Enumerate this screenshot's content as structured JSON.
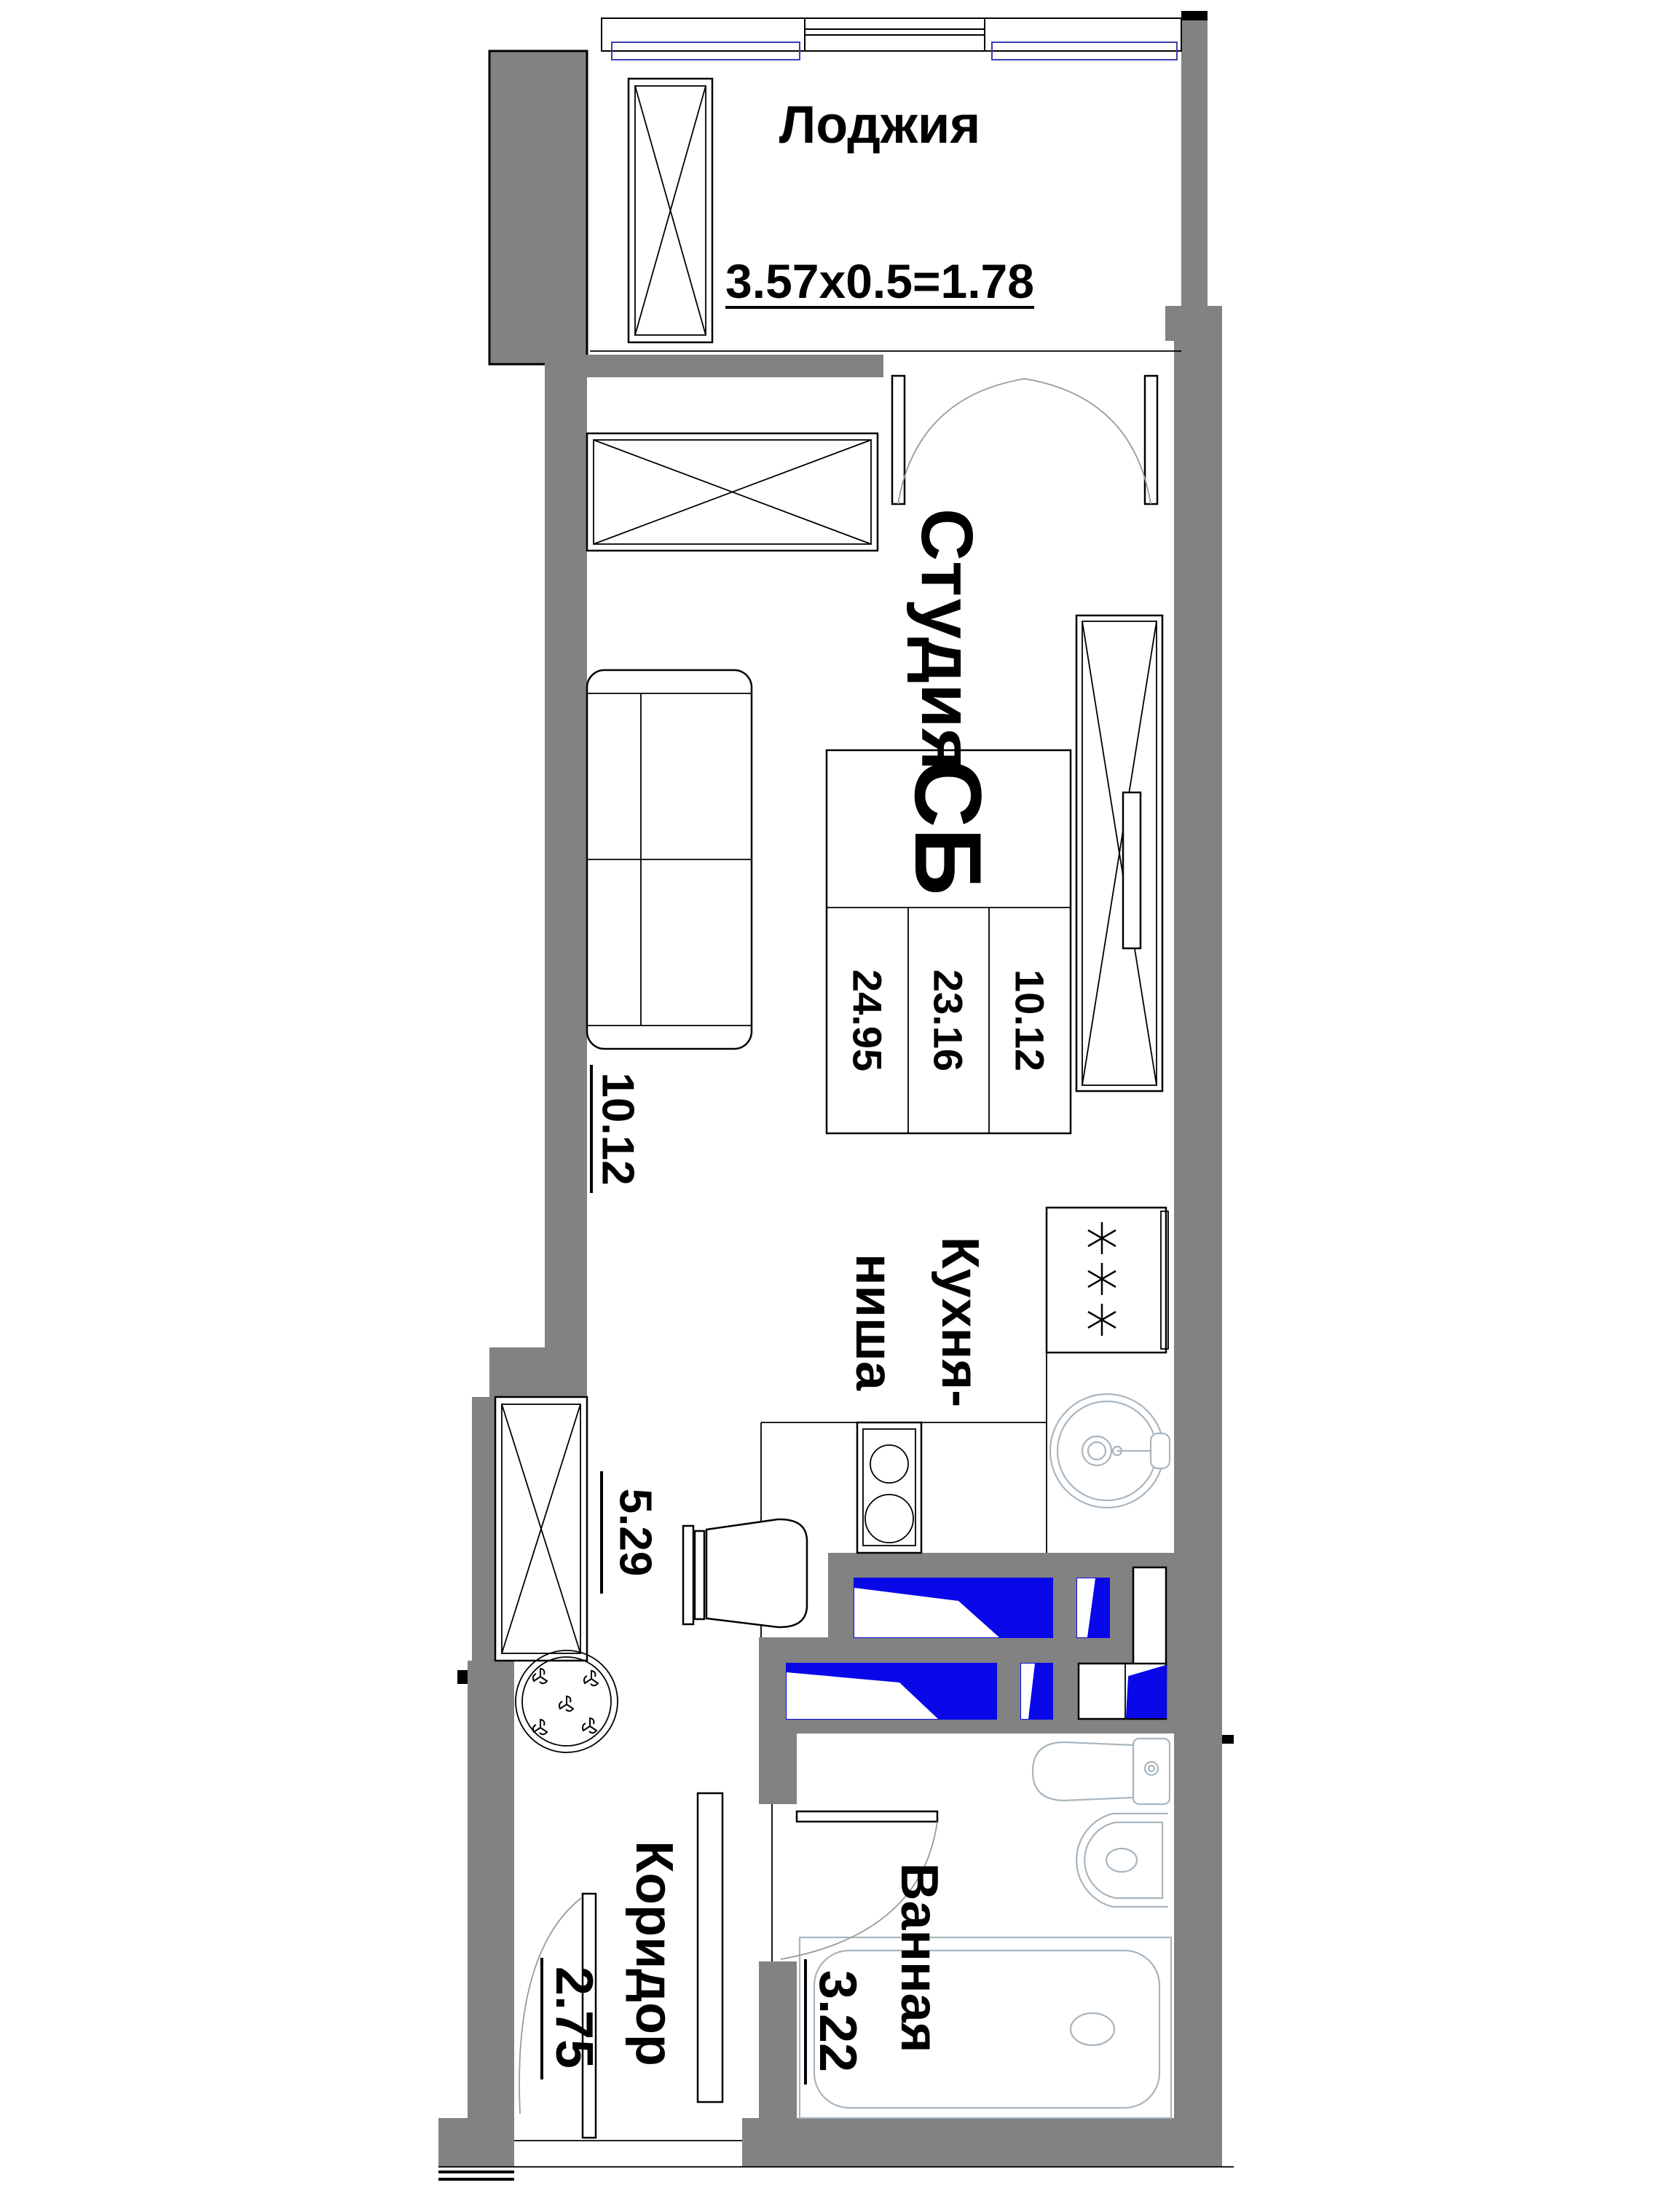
{
  "plan": {
    "title": "Studio apartment floor plan",
    "rooms": {
      "loggia": {
        "name": "Лоджия",
        "dimension": "3.57x0.5=1.78"
      },
      "studio": {
        "name": "Студия",
        "floor_area": "10.12"
      },
      "kitchen_niche": {
        "name_line1": "Кухня-",
        "name_line2": "ниша",
        "floor_area": "5.29"
      },
      "corridor": {
        "name": "Коридор",
        "floor_area": "2.75"
      },
      "bathroom": {
        "name": "Ванная",
        "floor_area": "3.22"
      }
    },
    "stamp": {
      "type_code": "СБ",
      "total_area": "24.95",
      "apartment_area": "23.16",
      "living_area": "10.12"
    },
    "colors": {
      "wall_gray": "#828282",
      "vent_blue": "#0808E8",
      "fixture_gray": "#A9B5BE",
      "glass_blue": "#3C3CB4"
    }
  }
}
